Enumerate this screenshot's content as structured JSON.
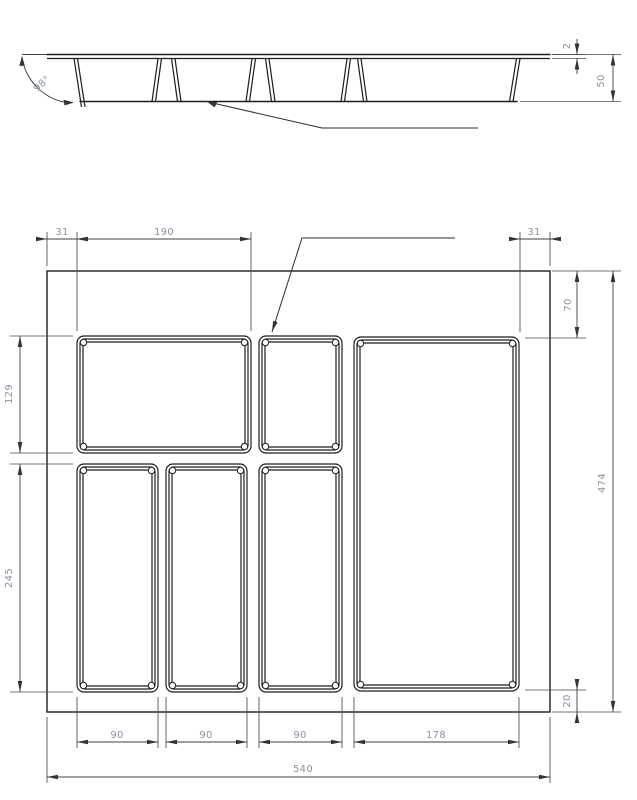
{
  "section_view": {
    "dim_rim_thickness": "2",
    "dim_height": "50",
    "dim_wall_angle": "98°"
  },
  "plan_view": {
    "dim_margin_left": "31",
    "dim_compartment1_width": "190",
    "dim_margin_right": "31",
    "dim_top_inset": "70",
    "dim_row1_height": "129",
    "dim_row2_height": "245",
    "dim_overall_height": "474",
    "dim_bottom_inset": "20",
    "dim_col1_width": "90",
    "dim_col2_width": "90",
    "dim_col3_width": "90",
    "dim_col4_width": "178",
    "dim_overall_width": "540"
  }
}
